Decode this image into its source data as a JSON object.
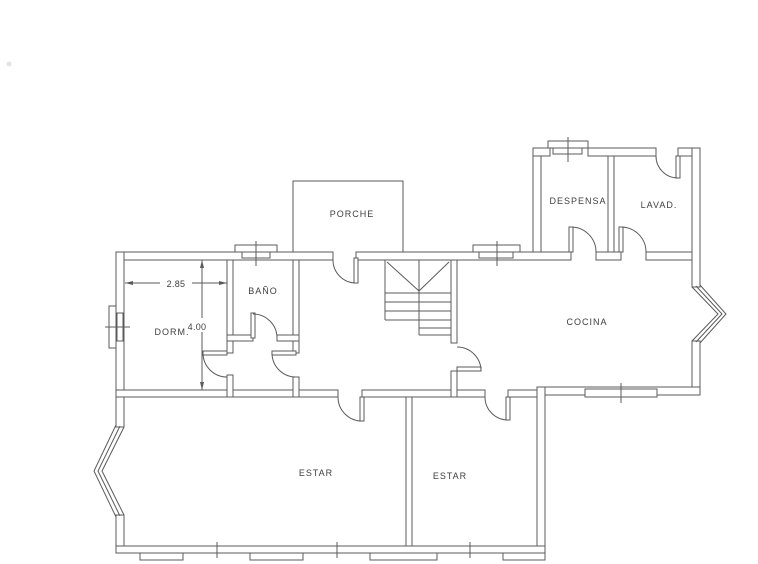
{
  "floor_plan": {
    "rooms": [
      {
        "id": "porche",
        "label": "PORCHE"
      },
      {
        "id": "despensa",
        "label": "DESPENSA"
      },
      {
        "id": "lavadero",
        "label": "LAVAD."
      },
      {
        "id": "bano",
        "label": "BAÑO"
      },
      {
        "id": "dormitorio",
        "label": "DORM."
      },
      {
        "id": "cocina",
        "label": "COCINA"
      },
      {
        "id": "estar_grande",
        "label": "ESTAR"
      },
      {
        "id": "estar_pequeno",
        "label": "ESTAR"
      }
    ],
    "dimensions": [
      {
        "id": "dorm_width",
        "value": "2.85"
      },
      {
        "id": "dorm_height",
        "value": "4.00"
      }
    ],
    "colors": {
      "line": "#5b5b5b",
      "text": "#3f3f3f",
      "background": "#ffffff"
    }
  }
}
